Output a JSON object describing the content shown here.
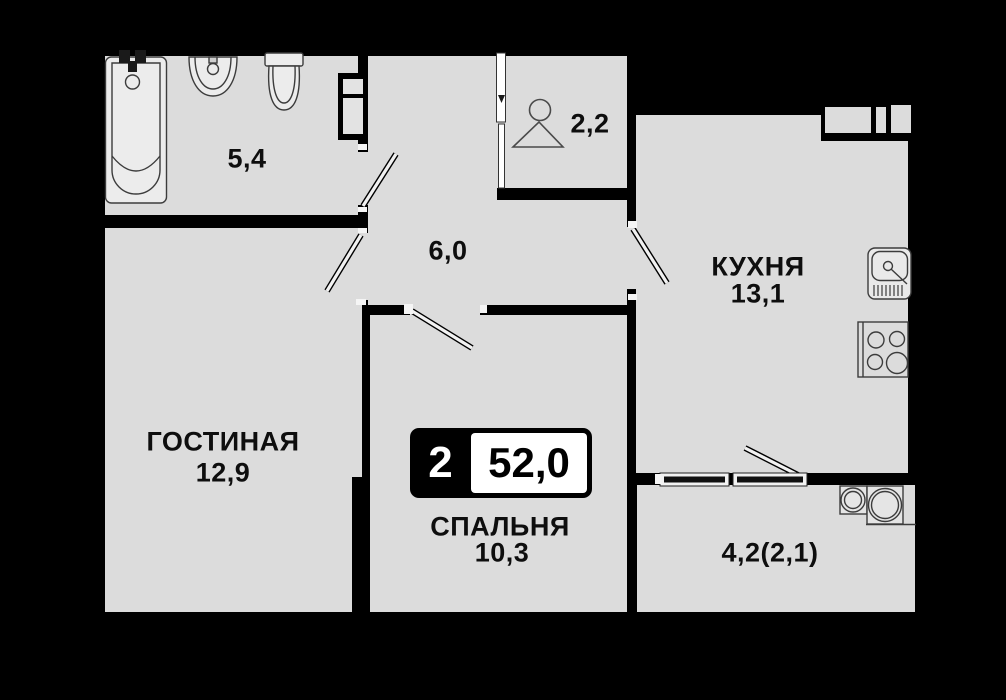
{
  "plan": {
    "badge": {
      "rooms": "2",
      "area": "52,0"
    },
    "rooms": {
      "bathroom": {
        "area": "5,4"
      },
      "wardrobe": {
        "area": "2,2"
      },
      "hallway": {
        "area": "6,0"
      },
      "kitchen": {
        "name": "КУХНЯ",
        "area": "13,1"
      },
      "living": {
        "name": "ГОСТИНАЯ",
        "area": "12,9"
      },
      "bedroom": {
        "name": "СПАЛЬНЯ",
        "area": "10,3"
      },
      "balcony": {
        "area": "4,2(2,1)"
      }
    },
    "icons": [
      "bathtub-icon",
      "wash-basin-icon",
      "toilet-icon",
      "duct-shaft",
      "hanger-icon",
      "sliding-door-icon",
      "door-leaf-icon",
      "kitchen-sink-icon",
      "stove-icon",
      "washing-machine-icon",
      "boiler-icon",
      "window-icon"
    ],
    "colors": {
      "floor": "#dcdcdc",
      "wall": "#000000",
      "fixture": "#ededed"
    }
  }
}
